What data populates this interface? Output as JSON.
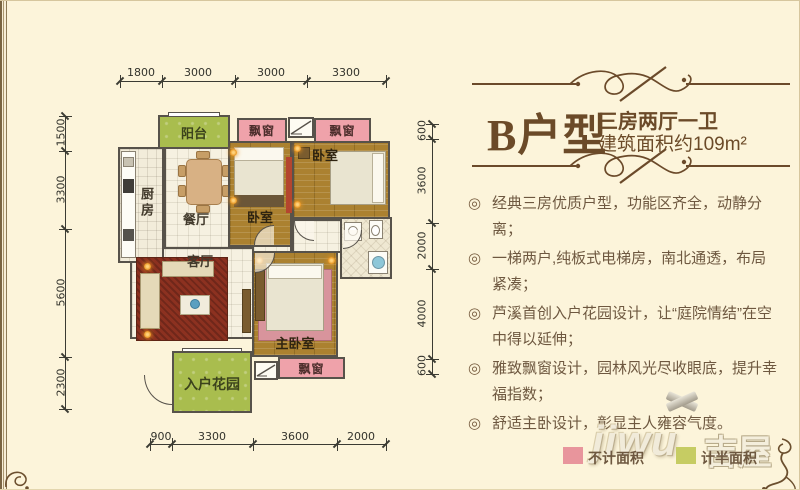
{
  "header": {
    "title": "B户型",
    "subtitle": "三房两厅一卫",
    "area": "建筑面积约109m²"
  },
  "features": {
    "marker": "◎",
    "items": [
      "经典三房优质户型，功能区齐全，动静分离；",
      "一梯两户,纯板式电梯房，南北通透，布局紧凑；",
      "芦溪首创入户花园设计，让“庭院情结”在空中得以延伸；",
      "雅致飘窗设计，园林风光尽收眼底，提升幸福指数；",
      "舒适主卧设计，彰显主人雍容气度。"
    ]
  },
  "plan": {
    "rooms": {
      "balcony": "阳台",
      "kitchen": "厨房",
      "dining": "餐厅",
      "living": "客厅",
      "bedroom1": "卧室",
      "bedroom2": "卧室",
      "master_bedroom": "主卧室",
      "entry_garden": "入户花园",
      "bay_window_top_left": "飘窗",
      "bay_window_top_right": "飘窗",
      "bay_window_bottom": "飘窗"
    }
  },
  "dimensions": {
    "top": [
      "1800",
      "3000",
      "3000",
      "3300"
    ],
    "left": [
      "1500",
      "3300",
      "5600",
      "2300"
    ],
    "right": [
      "600",
      "3600",
      "2000",
      "4000",
      "600"
    ],
    "bottom": [
      "900",
      "3300",
      "3600",
      "2000"
    ]
  },
  "legend": {
    "not_counted": {
      "label": "不计面积",
      "color": "#e8959c"
    },
    "half_counted": {
      "label": "计半面积",
      "color": "#c6cc63"
    }
  },
  "watermark": {
    "latin": "jiwu",
    "cn": "吉屋"
  },
  "colors": {
    "background": "#fcf4da",
    "title_text": "#6b4a28",
    "body_text": "#6e5840",
    "bay_window_pink": "#efa2aa",
    "green_area": "#a9bd4e",
    "wood_floor": "#ab8130",
    "carpet_red": "#8c3120",
    "wall": "#57524a"
  }
}
